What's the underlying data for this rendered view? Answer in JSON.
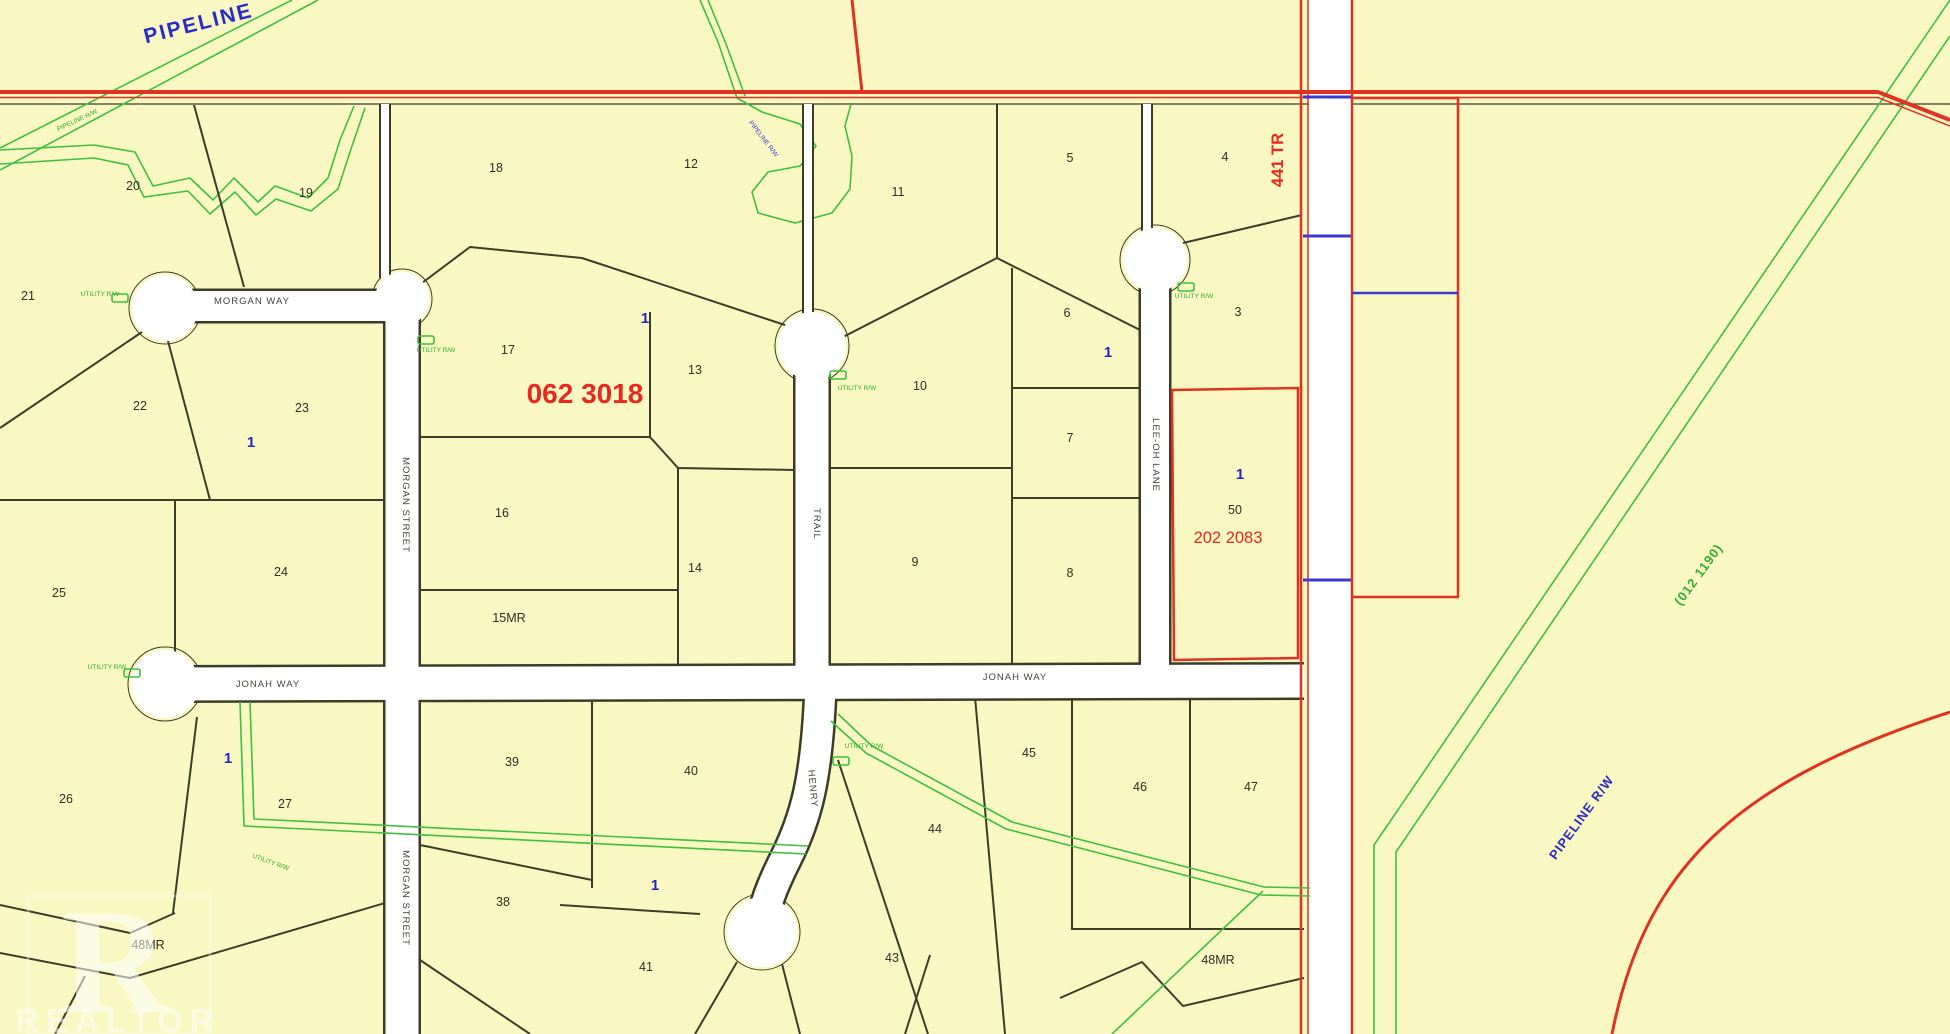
{
  "map": {
    "title": "Subdivision plat map",
    "background_color": "#f9f8c2",
    "road_fill_color": "#ffffff",
    "parcel_line_color": "#3c3c28",
    "highway_color": "#e03222",
    "pipeline_color": "#3fbf3f",
    "annotation_blue": "#2424c4",
    "plan_red": "#e8281c",
    "plan_numbers": [
      "062 3018",
      "202 2083",
      "441 TR",
      "(012 1190)"
    ],
    "street_names": [
      "MORGAN WAY",
      "MORGAN STREET",
      "TRAIL",
      "LEE-OH LANE",
      "JONAH WAY",
      "HENRY"
    ],
    "lot_numbers": [
      "1",
      "3",
      "4",
      "5",
      "6",
      "7",
      "8",
      "9",
      "10",
      "11",
      "12",
      "13",
      "14",
      "16",
      "17",
      "18",
      "19",
      "20",
      "21",
      "22",
      "23",
      "24",
      "25",
      "26",
      "27",
      "38",
      "39",
      "40",
      "41",
      "43",
      "44",
      "45",
      "46",
      "47",
      "50"
    ],
    "reserve_labels": [
      "15MR",
      "48MR"
    ],
    "rights_of_way": [
      "PIPELINE",
      "PIPELINE R/W",
      "UTILITY R/W"
    ]
  },
  "watermark": {
    "letter": "R",
    "word": "REALTOR"
  },
  "labels": [
    {
      "name": "lot-label-20",
      "cls": "lot",
      "text": "20",
      "x": 133,
      "y": 190
    },
    {
      "name": "lot-label-19",
      "cls": "lot",
      "text": "19",
      "x": 306,
      "y": 197
    },
    {
      "name": "lot-label-18",
      "cls": "lot",
      "text": "18",
      "x": 496,
      "y": 172
    },
    {
      "name": "lot-label-12",
      "cls": "lot",
      "text": "12",
      "x": 691,
      "y": 168
    },
    {
      "name": "lot-label-11",
      "cls": "lot",
      "text": "11",
      "x": 898,
      "y": 196
    },
    {
      "name": "lot-label-5",
      "cls": "lot",
      "text": "5",
      "x": 1070,
      "y": 162
    },
    {
      "name": "lot-label-4",
      "cls": "lot",
      "text": "4",
      "x": 1225,
      "y": 161
    },
    {
      "name": "lot-label-21",
      "cls": "lot",
      "text": "21",
      "x": 28,
      "y": 300
    },
    {
      "name": "lot-label-22",
      "cls": "lot",
      "text": "22",
      "x": 140,
      "y": 410
    },
    {
      "name": "lot-label-23",
      "cls": "lot",
      "text": "23",
      "x": 302,
      "y": 412
    },
    {
      "name": "lot-label-17",
      "cls": "lot",
      "text": "17",
      "x": 508,
      "y": 354
    },
    {
      "name": "lot-label-13",
      "cls": "lot",
      "text": "13",
      "x": 695,
      "y": 374
    },
    {
      "name": "lot-label-6",
      "cls": "lot",
      "text": "6",
      "x": 1067,
      "y": 317
    },
    {
      "name": "lot-label-3",
      "cls": "lot",
      "text": "3",
      "x": 1238,
      "y": 316
    },
    {
      "name": "lot-label-10",
      "cls": "lot",
      "text": "10",
      "x": 920,
      "y": 390
    },
    {
      "name": "lot-label-7",
      "cls": "lot",
      "text": "7",
      "x": 1070,
      "y": 442
    },
    {
      "name": "lot-label-16",
      "cls": "lot",
      "text": "16",
      "x": 502,
      "y": 517
    },
    {
      "name": "lot-label-14",
      "cls": "lot",
      "text": "14",
      "x": 695,
      "y": 572
    },
    {
      "name": "lot-label-9",
      "cls": "lot",
      "text": "9",
      "x": 915,
      "y": 566
    },
    {
      "name": "lot-label-8",
      "cls": "lot",
      "text": "8",
      "x": 1070,
      "y": 577
    },
    {
      "name": "lot-label-50",
      "cls": "lot",
      "text": "50",
      "x": 1235,
      "y": 514
    },
    {
      "name": "lot-label-24",
      "cls": "lot",
      "text": "24",
      "x": 281,
      "y": 576
    },
    {
      "name": "lot-label-25",
      "cls": "lot",
      "text": "25",
      "x": 59,
      "y": 597
    },
    {
      "name": "reserve-label-15mr",
      "cls": "lot",
      "text": "15MR",
      "x": 509,
      "y": 622
    },
    {
      "name": "lot-label-26",
      "cls": "lot",
      "text": "26",
      "x": 66,
      "y": 803
    },
    {
      "name": "lot-label-27",
      "cls": "lot",
      "text": "27",
      "x": 285,
      "y": 808
    },
    {
      "name": "lot-label-39",
      "cls": "lot",
      "text": "39",
      "x": 512,
      "y": 766
    },
    {
      "name": "lot-label-40",
      "cls": "lot",
      "text": "40",
      "x": 691,
      "y": 775
    },
    {
      "name": "lot-label-45",
      "cls": "lot",
      "text": "45",
      "x": 1029,
      "y": 757
    },
    {
      "name": "lot-label-46",
      "cls": "lot",
      "text": "46",
      "x": 1140,
      "y": 791
    },
    {
      "name": "lot-label-47",
      "cls": "lot",
      "text": "47",
      "x": 1251,
      "y": 791
    },
    {
      "name": "lot-label-44",
      "cls": "lot",
      "text": "44",
      "x": 935,
      "y": 833
    },
    {
      "name": "lot-label-38",
      "cls": "lot",
      "text": "38",
      "x": 503,
      "y": 906
    },
    {
      "name": "lot-label-41",
      "cls": "lot",
      "text": "41",
      "x": 646,
      "y": 971
    },
    {
      "name": "lot-label-43",
      "cls": "lot",
      "text": "43",
      "x": 892,
      "y": 962
    },
    {
      "name": "reserve-label-48mr-west",
      "cls": "lot",
      "text": "48MR",
      "x": 148,
      "y": 949
    },
    {
      "name": "reserve-label-48mr-east",
      "cls": "lot",
      "text": "48MR",
      "x": 1218,
      "y": 964
    },
    {
      "name": "unit-count-1",
      "cls": "unit",
      "text": "1",
      "x": 251,
      "y": 447
    },
    {
      "name": "unit-count-1",
      "cls": "unit",
      "text": "1",
      "x": 645,
      "y": 323
    },
    {
      "name": "unit-count-1",
      "cls": "unit",
      "text": "1",
      "x": 1108,
      "y": 357
    },
    {
      "name": "unit-count-1",
      "cls": "unit",
      "text": "1",
      "x": 1240,
      "y": 479
    },
    {
      "name": "unit-count-1",
      "cls": "unit",
      "text": "1",
      "x": 228,
      "y": 763
    },
    {
      "name": "unit-count-1",
      "cls": "unit",
      "text": "1",
      "x": 655,
      "y": 890
    },
    {
      "name": "plan-number-062-3018",
      "cls": "plan-lg",
      "text": "062 3018",
      "x": 585,
      "y": 403
    },
    {
      "name": "plan-number-202-2083",
      "cls": "plan-md",
      "text": "202 2083",
      "x": 1228,
      "y": 543
    },
    {
      "name": "plan-number-441-tr",
      "cls": "plan-md plan-bold",
      "text": "441 TR",
      "x": 1283,
      "y": 160,
      "rot": -90
    },
    {
      "name": "street-label-morgan-way",
      "cls": "street",
      "text": "MORGAN WAY",
      "x": 252,
      "y": 304
    },
    {
      "name": "street-label-morgan-street",
      "cls": "street",
      "text": "MORGAN STREET",
      "x": 403,
      "y": 505,
      "rot": 90
    },
    {
      "name": "street-label-morgan-street",
      "cls": "street",
      "text": "MORGAN STREET",
      "x": 403,
      "y": 898,
      "rot": 90
    },
    {
      "name": "street-label-trail",
      "cls": "street",
      "text": "TRAIL",
      "x": 814,
      "y": 524,
      "rot": 90
    },
    {
      "name": "street-label-lee-oh-lane",
      "cls": "street",
      "text": "LEE-OH LANE",
      "x": 1153,
      "y": 455,
      "rot": 90
    },
    {
      "name": "street-label-jonah-way",
      "cls": "street",
      "text": "JONAH WAY",
      "x": 268,
      "y": 687
    },
    {
      "name": "street-label-jonah-way",
      "cls": "street",
      "text": "JONAH WAY",
      "x": 1015,
      "y": 680
    },
    {
      "name": "street-label-henry",
      "cls": "street",
      "text": "HENRY",
      "x": 810,
      "y": 789,
      "rot": 85
    },
    {
      "name": "pipeline-label-main",
      "cls": "pipeline-lg",
      "text": "PIPELINE",
      "x": 200,
      "y": 30,
      "rot": -14
    },
    {
      "name": "pipeline-rw-label",
      "cls": "pip-blue",
      "text": "PIPELINE R/W",
      "x": 1585,
      "y": 820,
      "rot": -54
    },
    {
      "name": "pipeline-plan-label",
      "cls": "pip-green",
      "text": "(012 1190)",
      "x": 1702,
      "y": 577,
      "rot": -54
    },
    {
      "name": "pipeline-rw-tiny",
      "cls": "tiny-green",
      "text": "PIPELINE R/W",
      "x": 78,
      "y": 122,
      "rot": -25
    },
    {
      "name": "pipeline-rw-tiny",
      "cls": "tiny-blue",
      "text": "PIPELINE R/W",
      "x": 762,
      "y": 140,
      "rot": 52
    },
    {
      "name": "utility-rw-label",
      "cls": "tiny-green",
      "text": "UTILITY R/W",
      "x": 100,
      "y": 296
    },
    {
      "name": "utility-rw-label",
      "cls": "tiny-green",
      "text": "UTILITY R/W",
      "x": 436,
      "y": 352
    },
    {
      "name": "utility-rw-label",
      "cls": "tiny-green",
      "text": "UTILITY R/W",
      "x": 857,
      "y": 390
    },
    {
      "name": "utility-rw-label",
      "cls": "tiny-green",
      "text": "UTILITY R/W",
      "x": 1194,
      "y": 298
    },
    {
      "name": "utility-rw-label",
      "cls": "tiny-green",
      "text": "UTILITY R/W",
      "x": 107,
      "y": 669
    },
    {
      "name": "utility-rw-label",
      "cls": "tiny-green",
      "text": "UTILITY R/W",
      "x": 864,
      "y": 748
    },
    {
      "name": "utility-rw-label",
      "cls": "tiny-green",
      "text": "UTILITY R/W",
      "x": 270,
      "y": 864,
      "rot": 20
    }
  ]
}
